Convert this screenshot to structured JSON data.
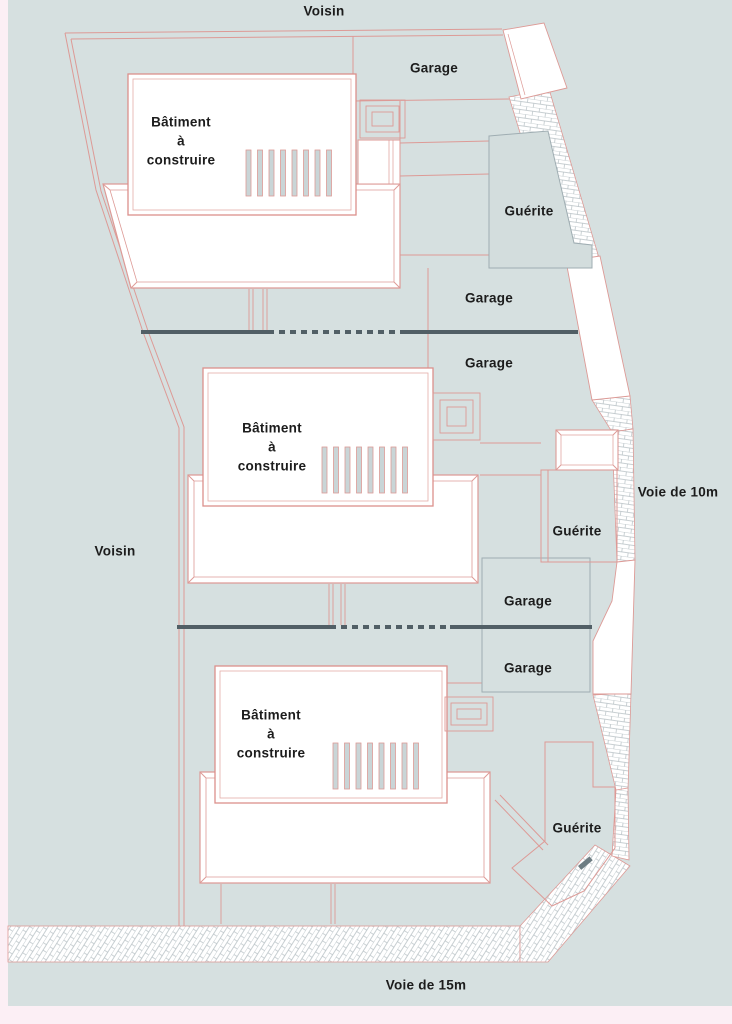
{
  "colors": {
    "site_fill": "#d6e0e0",
    "margin_fill": "#fceff5",
    "parcel_line": "#dd9a96",
    "structure_line": "#9fadb2",
    "separator_line": "#515f66",
    "building_fill": "#ffffff",
    "hatch_line": "#b6c0c4",
    "bar_fill": "#c9d5d7",
    "text_color": "#1c1c1c"
  },
  "neighbors": {
    "top": "Voisin",
    "left": "Voisin"
  },
  "roads": {
    "right": "Voie de 10m",
    "bottom": "Voie de 15m"
  },
  "buildings": [
    {
      "label_line1": "Bâtiment",
      "label_line2": "à",
      "label_line3": "construire"
    },
    {
      "label_line1": "Bâtiment",
      "label_line2": "à",
      "label_line3": "construire"
    },
    {
      "label_line1": "Bâtiment",
      "label_line2": "à",
      "label_line3": "construire"
    }
  ],
  "garages": [
    "Garage",
    "Garage",
    "Garage",
    "Garage",
    "Garage"
  ],
  "guerites": [
    "Guérite",
    "Guérite",
    "Guérite"
  ]
}
